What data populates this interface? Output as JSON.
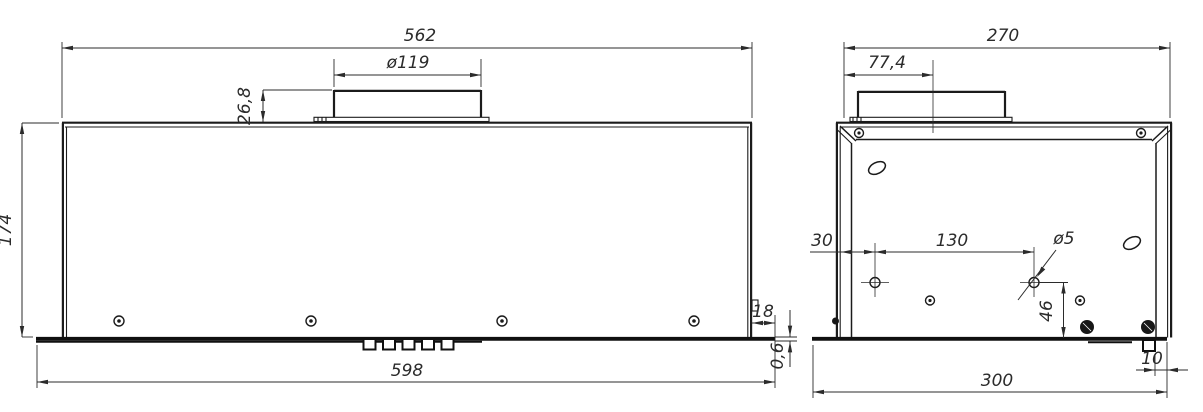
{
  "drawing": {
    "front_view": {
      "overall_width": "562",
      "duct_diameter": "ø119",
      "duct_height": "26,8",
      "body_height": "174",
      "base_width": "598",
      "base_right_overhang": "18",
      "base_thickness": "0,6"
    },
    "side_view": {
      "overall_depth": "270",
      "duct_center_offset": "77,4",
      "hole_edge_offset": "30",
      "hole_spacing": "130",
      "hole_diameter": "ø5",
      "hole_bottom_offset": "46",
      "rear_tab_offset": "10",
      "base_depth": "300"
    }
  }
}
